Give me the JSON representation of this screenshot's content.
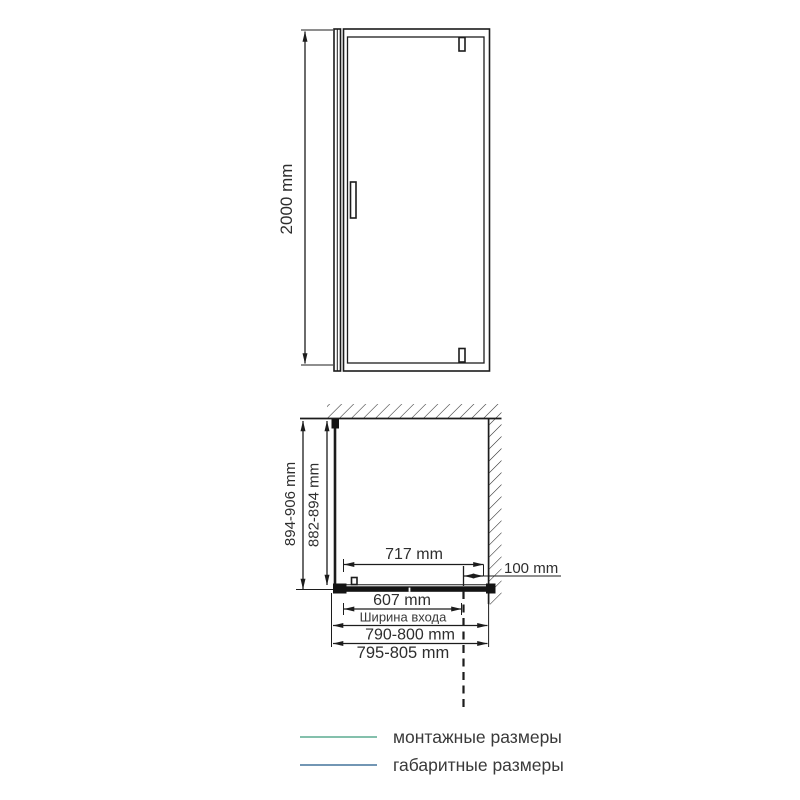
{
  "colors": {
    "drawing": "#1c1c1c",
    "green": "#21a366",
    "blue": "#2f618f",
    "legend_green": "#5cab91",
    "legend_blue": "#44749c"
  },
  "front_view": {
    "height_label": "2000 mm"
  },
  "plan_view": {
    "overall_depth_label": "894-906 mm",
    "mounting_depth_label": "882-894 mm",
    "glass_width_label": "717 mm",
    "wall_distance_label": "100 mm",
    "entrance_width_label": "607 mm",
    "entrance_width_caption": "Ширина входа",
    "mounting_width_label": "790-800 mm",
    "overall_width_label": "795-805 mm"
  },
  "legend": {
    "items": [
      {
        "label": "монтажные размеры",
        "color": "#5cab91"
      },
      {
        "label": "габаритные размеры",
        "color": "#44749c"
      }
    ]
  }
}
